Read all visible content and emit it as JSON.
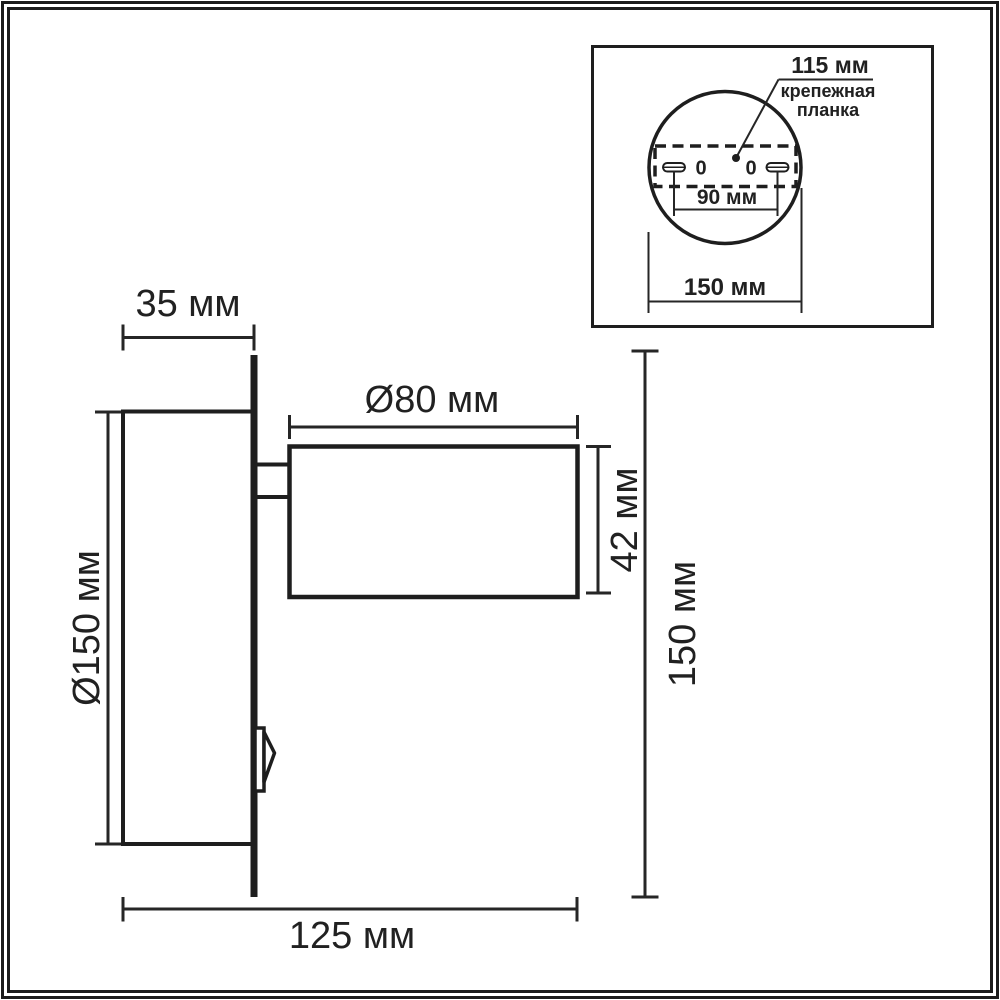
{
  "figure": {
    "description": "wall-lamp-dimension-drawing"
  },
  "labels": {
    "main": {
      "base_depth": "35 мм",
      "head_diameter": "Ø80 мм",
      "base_diameter": "Ø150 мм",
      "head_height": "42 мм",
      "total_height": "150 мм",
      "total_depth": "125 мм"
    },
    "inset": {
      "plate_length": "115 мм",
      "plate_name_line1": "крепежная",
      "plate_name_line2": "планка",
      "hole_spacing": "90 мм",
      "base_diameter": "150 мм",
      "hole_left": "0",
      "hole_right": "0"
    }
  },
  "colors": {
    "line": "#1e1e1e",
    "dimension_line": "#262626",
    "text": "#212121",
    "background": "#ffffff",
    "frame": "#1b1b1b"
  }
}
